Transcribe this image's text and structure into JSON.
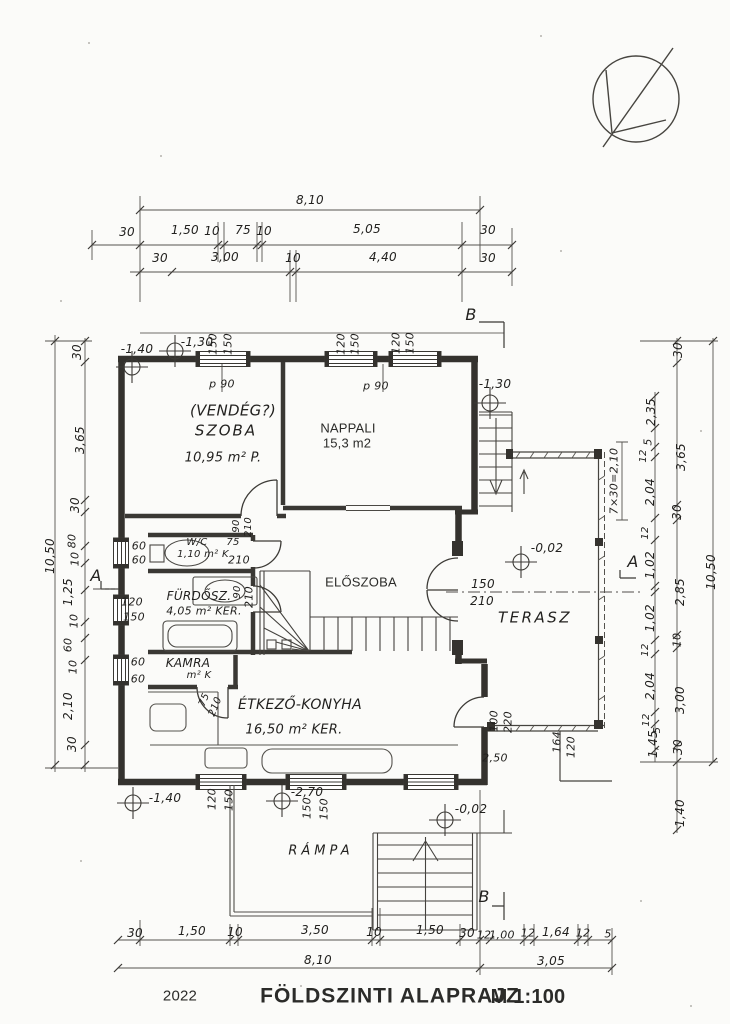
{
  "title_block": {
    "year": "2022",
    "title": "FÖLDSZINTI ALAPRAJZ",
    "scale": "M 1:100"
  },
  "rooms": {
    "szoba": {
      "line1": "(VENDÉG?)",
      "line2": "SZOBA",
      "area": "10,95 m² P."
    },
    "nappali": {
      "name": "NAPPALI",
      "area": "15,3 m2"
    },
    "eloszoba": {
      "name": "ELŐSZOBA"
    },
    "wc": {
      "name": "W/C",
      "area": "1,10 m² K"
    },
    "furdo": {
      "name": "FÜRDŐSZ.",
      "area": "4,05 m² KER."
    },
    "kamra": {
      "name": "KAMRA",
      "area": "m² K"
    },
    "konyha": {
      "name": "ÉTKEZŐ-KONYHA",
      "area": "16,50 m² KER."
    },
    "terasz": {
      "name": "TERASZ"
    },
    "rampa": {
      "name": "RÁMPA"
    }
  },
  "levels": {
    "nw_outer": "-1,40",
    "nw_inner": "-1,30",
    "ne": "-1,30",
    "terrace": "-0,02",
    "ramp": "-2,70",
    "sw": "-1,40",
    "south": "-0,02"
  },
  "sections": {
    "a": "A",
    "b": "B"
  },
  "dims": {
    "top": {
      "total": "8,10",
      "row1": [
        "30",
        "1,50",
        "10",
        "75",
        "10",
        "5,05",
        "30"
      ],
      "row2": [
        "30",
        "3,00",
        "10",
        "4,40",
        "30"
      ]
    },
    "bottom": {
      "row": [
        "30",
        "1,50",
        "10",
        "3,50",
        "10",
        "1,50",
        "30",
        "12",
        "1,00",
        "12",
        "1,64",
        "12",
        "5"
      ],
      "total_left": "8,10",
      "total_right": "3,05"
    },
    "left": {
      "col": [
        "30",
        "3,65",
        "30",
        "80",
        "10",
        "1,25",
        "10",
        "60",
        "10",
        "2,10",
        "30"
      ],
      "total": "10,50"
    },
    "right_inner": [
      "2,35",
      "5",
      "12",
      "2,04",
      "12",
      "1,02",
      "1,02",
      "12",
      "2,04",
      "12",
      "1,45",
      "5"
    ],
    "right_outer": [
      "30",
      "3,65",
      "30",
      "2,85",
      "10",
      "3,00",
      "30",
      "1,40"
    ],
    "right_total": "10,50",
    "steps": "7×30=2,10"
  },
  "openings": {
    "szoba_window": [
      "150",
      "150"
    ],
    "szoba_parapet": "p 90",
    "nappali_window1": [
      "120",
      "150"
    ],
    "nappali_window2": [
      "120",
      "150"
    ],
    "nappali_parapet": "p 90",
    "wc_window": [
      "60",
      "60"
    ],
    "furdo_window": [
      "120",
      "150"
    ],
    "kamra_window": [
      "60",
      "60"
    ],
    "wc_door": [
      "75",
      "210"
    ],
    "furdo_door": [
      "90",
      "210"
    ],
    "szoba_door": [
      "90",
      "210"
    ],
    "kamra_door": [
      "75",
      "210"
    ],
    "entry_door": [
      "150",
      "210"
    ],
    "kitchen_terrace_door": [
      "100",
      "220"
    ],
    "kitchen_terrace_dim": "2,50",
    "terrace_step": [
      "164",
      "120"
    ],
    "kitchen_window1": [
      "120",
      "150"
    ],
    "kitchen_window2": [
      "150",
      "150"
    ]
  }
}
